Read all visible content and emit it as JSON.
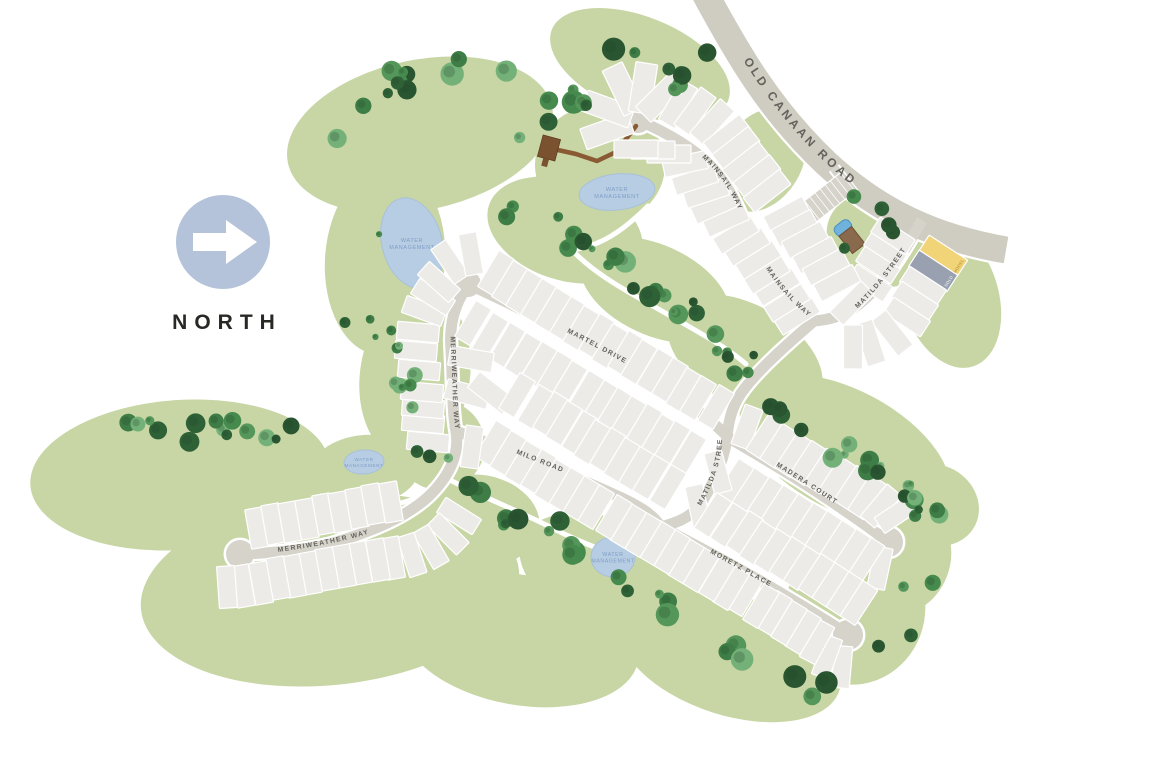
{
  "north_label": "NORTH",
  "water_label": [
    "WATER",
    "MANAGEMENT"
  ],
  "colors": {
    "green": "#c7d6a4",
    "road": "#d6d3cb",
    "highway": "#cfccc1",
    "lot": "#ecebe7",
    "lot_line": "#ffffff",
    "water": "#b7cde3",
    "water_text": "#7f9dc6",
    "number": "#4e4c46",
    "street_text": "#63625c",
    "north_circle": "#b4c3d9",
    "model": "#f2d478",
    "sold": "#99a1b0",
    "boardwalk": "#8a5a35",
    "trail": "#ffffff"
  },
  "special_lots": {
    "1": {
      "fill": "#f2d478",
      "edge_label": "MODEL",
      "edge_color": "#a98b2f"
    },
    "2": {
      "fill": "#99a1b0",
      "edge_label": "SOLD",
      "edge_color": "#ffffff"
    }
  },
  "streets": [
    {
      "name": "OLD CANAAN ROAD",
      "kind": "highway",
      "width": 27,
      "path": "M702,-12 C738,55 770,110 826,163 C880,213 936,238 1006,250",
      "labels": [
        {
          "offset": "20%",
          "size": 12,
          "spacing": 3.2
        }
      ]
    },
    {
      "name": "MAINSAIL WAY",
      "width": 11,
      "path": "M638,120 C672,135 700,152 716,172 C736,196 744,224 757,252 C770,280 793,305 814,321",
      "labels": [
        {
          "offset": "27%",
          "size": 6.8,
          "spacing": 1.3
        },
        {
          "offset": "74%",
          "size": 6.8,
          "spacing": 1.3
        }
      ]
    },
    {
      "name": "MATILDA STREET",
      "width": 11,
      "path": "M922,220 C904,252 884,286 854,308 C842,316 828,320 814,321",
      "labels": [
        {
          "size": 6.8,
          "spacing": 1.3,
          "offset": "2%",
          "path": "M856,310 C884,284 906,252 924,218"
        }
      ]
    },
    {
      "name": "MATILDA STREET",
      "width": 11,
      "path": "M814,321 C790,342 762,366 745,388 C733,403 729,418 727,436 C725,458 713,487 698,507 C688,519 675,523 661,527",
      "labels": [
        {
          "size": 6.8,
          "spacing": 1.3,
          "offset": "0%",
          "path": "M701,506 C713,484 721,464 722,440"
        }
      ]
    },
    {
      "name": "MARTEL DRIVE",
      "width": 11,
      "path": "M470,285 C520,308 580,338 630,366 C668,387 706,415 727,436",
      "labels": [
        {
          "offset": "36%",
          "size": 6.8,
          "spacing": 1.3
        }
      ]
    },
    {
      "name": "MERRIWEATHER WAY",
      "width": 11,
      "path": "M468,285 C454,305 449,325 451,350 C453,385 452,410 456,432 C460,455 448,478 428,497 C405,518 370,532 330,544 C300,551 270,553 240,554",
      "labels": [
        {
          "offset": "13%",
          "size": 6.8,
          "spacing": 1.3
        },
        {
          "size": 6.8,
          "spacing": 1.3,
          "offset": "0%",
          "path": "M278,552 C322,546 362,538 400,523"
        }
      ]
    },
    {
      "name": "MILO ROAD",
      "width": 11,
      "path": "M456,431 C515,453 565,472 613,494 C638,505 653,514 661,527",
      "labels": [
        {
          "offset": "28%",
          "size": 6.8,
          "spacing": 1.3
        }
      ]
    },
    {
      "name": "MADERA COURT",
      "width": 11,
      "path": "M727,437 C772,463 824,494 886,540",
      "labels": [
        {
          "offset": "30%",
          "size": 6.8,
          "spacing": 1.3
        }
      ]
    },
    {
      "name": "MORETZ PLACE",
      "width": 11,
      "path": "M661,527 C705,550 768,583 846,633",
      "labels": [
        {
          "offset": "26%",
          "size": 6.8,
          "spacing": 1.3
        }
      ]
    }
  ],
  "culdesacs": [
    [
      638,
      120,
      13
    ],
    [
      468,
      284,
      13
    ],
    [
      240,
      554,
      14
    ],
    [
      888,
      542,
      15
    ],
    [
      848,
      635,
      15
    ]
  ],
  "ponds": [
    {
      "cx": 412,
      "cy": 243,
      "rx": 30,
      "ry": 46,
      "rot": -15,
      "size": 5.5
    },
    {
      "cx": 617,
      "cy": 192,
      "rx": 38,
      "ry": 18,
      "rot": -6,
      "size": 5.5
    },
    {
      "cx": 364,
      "cy": 462,
      "rx": 20,
      "ry": 12,
      "rot": -4,
      "size": 4.6
    },
    {
      "cx": 613,
      "cy": 557,
      "rx": 22,
      "ry": 20,
      "rot": 0,
      "size": 5.2
    }
  ],
  "lot_rows": [
    {
      "pr": -57,
      "tr": -57,
      "w": 20,
      "h": 46,
      "lots": [
        [
          1,
          943,
          256
        ],
        [
          2,
          933,
          271
        ]
      ]
    },
    {
      "pr": -57,
      "tr": -40,
      "w": 19,
      "h": 44,
      "lots": [
        [
          3,
          923,
          286
        ],
        [
          4,
          915,
          301
        ],
        [
          5,
          907,
          317
        ],
        [
          6,
          892,
          333,
          -38
        ],
        [
          7,
          870,
          343,
          -18,
          -28
        ],
        [
          8,
          853,
          347,
          0,
          -12
        ]
      ]
    },
    {
      "pr": -57,
      "tr": -30,
      "w": 18,
      "h": 42,
      "lots": [
        [
          186,
          870,
          283
        ],
        [
          187,
          878,
          265
        ],
        [
          188,
          886,
          249
        ],
        [
          189,
          893,
          236
        ]
      ]
    },
    {
      "pr": 62,
      "tr": -28,
      "w": 19,
      "h": 44,
      "lots": [
        [
          179,
          787,
          215
        ],
        [
          180,
          795,
          228
        ],
        [
          181,
          805,
          240
        ],
        [
          182,
          816,
          255
        ],
        [
          183,
          826,
          267
        ],
        [
          184,
          837,
          283
        ],
        [
          185,
          852,
          303,
          45
        ]
      ]
    },
    {
      "pr": 58,
      "tr": -40,
      "w": 18,
      "h": 44,
      "lots": [
        [
          151,
          797,
          316
        ],
        [
          152,
          787,
          303
        ],
        [
          153,
          777,
          287
        ],
        [
          154,
          767,
          275
        ],
        [
          155,
          758,
          260
        ],
        [
          156,
          747,
          247
        ],
        [
          157,
          736,
          235
        ],
        [
          158,
          726,
          220,
          66,
          -15
        ],
        [
          159,
          714,
          207,
          66,
          -15
        ],
        [
          160,
          706,
          193,
          72,
          -12
        ],
        [
          161,
          695,
          180,
          72,
          -12
        ],
        [
          162,
          685,
          164,
          78,
          -15
        ],
        [
          163,
          669,
          154,
          90,
          0
        ],
        [
          164,
          653,
          150,
          90,
          0
        ],
        [
          165,
          636,
          149,
          90,
          0
        ]
      ]
    },
    {
      "fan": [
        638,
        120
      ],
      "tr": -8,
      "w": 22,
      "h": 50,
      "lots": [
        [
          166,
          607,
          131,
          null,
          -12
        ],
        [
          167,
          608,
          109,
          null,
          -12
        ],
        [
          168,
          623,
          89
        ],
        [
          169,
          643,
          88,
          null,
          -4
        ],
        [
          170,
          661,
          97,
          null,
          12
        ]
      ]
    },
    {
      "pr": 52,
      "tr": 42,
      "w": 19,
      "h": 46,
      "lots": [
        [
          171,
          678,
          104,
          30,
          18
        ],
        [
          172,
          695,
          111,
          36,
          26
        ],
        [
          173,
          712,
          122,
          42,
          34
        ],
        [
          174,
          727,
          136
        ],
        [
          175,
          736,
          148
        ],
        [
          176,
          746,
          163
        ],
        [
          177,
          757,
          176
        ],
        [
          178,
          767,
          191
        ]
      ]
    },
    {
      "pr": 31,
      "tr": 28,
      "w": 18,
      "h": 42,
      "lots": [
        [
          106,
          496,
          273
        ],
        [
          107,
          510,
          283
        ],
        [
          108,
          524,
          292
        ],
        [
          109,
          539,
          301
        ],
        [
          110,
          553,
          310
        ],
        [
          111,
          568,
          319
        ],
        [
          112,
          581,
          328
        ],
        [
          113,
          597,
          336
        ],
        [
          114,
          610,
          346
        ],
        [
          115,
          626,
          353
        ],
        [
          116,
          639,
          362
        ],
        [
          117,
          655,
          371
        ],
        [
          118,
          670,
          380
        ],
        [
          119,
          684,
          390
        ],
        [
          120,
          698,
          398
        ],
        [
          121,
          716,
          407
        ]
      ]
    },
    {
      "pr": 31,
      "tr": 28,
      "w": 18,
      "h": 42,
      "lots": [
        [
          122,
          688,
          453
        ],
        [
          123,
          672,
          443
        ],
        [
          124,
          656,
          435
        ],
        [
          125,
          644,
          426
        ],
        [
          126,
          628,
          418
        ],
        [
          127,
          613,
          409
        ],
        [
          128,
          599,
          401
        ],
        [
          129,
          586,
          393
        ],
        [
          130,
          569,
          383
        ],
        [
          131,
          554,
          373
        ],
        [
          132,
          539,
          364
        ],
        [
          133,
          523,
          355
        ],
        [
          134,
          507,
          345
        ],
        [
          135,
          490,
          335
        ],
        [
          136,
          473,
          323
        ]
      ]
    },
    {
      "pr": -80,
      "tr": 0,
      "w": 20,
      "h": 44,
      "lots": [
        [
          137,
          471,
          359
        ],
        [
          138,
          467,
          394,
          -75
        ],
        [
          139,
          491,
          393,
          -52
        ]
      ]
    },
    {
      "pr": 31,
      "tr": 28,
      "w": 18,
      "h": 42,
      "lots": [
        [
          140,
          517,
          395
        ],
        [
          141,
          536,
          407
        ],
        [
          142,
          551,
          414
        ],
        [
          143,
          564,
          423
        ],
        [
          144,
          580,
          433
        ],
        [
          145,
          592,
          442
        ],
        [
          146,
          608,
          450
        ],
        [
          147,
          622,
          460
        ],
        [
          148,
          637,
          469
        ],
        [
          149,
          651,
          477
        ],
        [
          150,
          668,
          487
        ]
      ]
    },
    {
      "pr": -85,
      "tr": 0,
      "w": 18,
      "h": 42,
      "lots": [
        [
          94,
          428,
          442
        ],
        [
          95,
          423,
          423
        ],
        [
          96,
          423,
          408
        ],
        [
          97,
          422,
          392
        ],
        [
          98,
          419,
          370
        ],
        [
          99,
          416,
          351
        ],
        [
          100,
          418,
          332
        ],
        [
          101,
          424,
          311,
          -70
        ],
        [
          102,
          433,
          297,
          -58
        ],
        [
          103,
          439,
          282,
          -48
        ],
        [
          104,
          450,
          262,
          -34
        ],
        [
          105,
          471,
          254,
          -10
        ]
      ]
    },
    {
      "pr": 31,
      "tr": 28,
      "w": 18,
      "h": 42,
      "lots": [
        [
          61,
          596,
          507
        ],
        [
          62,
          581,
          498
        ],
        [
          63,
          566,
          489
        ],
        [
          64,
          552,
          481
        ],
        [
          65,
          538,
          471
        ],
        [
          66,
          523,
          463
        ],
        [
          67,
          508,
          453
        ],
        [
          68,
          493,
          443
        ],
        [
          69,
          472,
          447,
          8,
          0
        ]
      ]
    },
    {
      "pr": 31,
      "tr": 28,
      "w": 18,
      "h": 42,
      "lots": [
        [
          44,
          842,
          667,
          5,
          20
        ],
        [
          45,
          827,
          657,
          20,
          24
        ],
        [
          46,
          817,
          642,
          28
        ],
        [
          47,
          803,
          632
        ],
        [
          48,
          789,
          623
        ],
        [
          49,
          774,
          613
        ],
        [
          50,
          761,
          606
        ],
        [
          51,
          745,
          594
        ],
        [
          52,
          731,
          588
        ],
        [
          53,
          717,
          579
        ],
        [
          54,
          701,
          570
        ],
        [
          55,
          686,
          561
        ],
        [
          56,
          672,
          552
        ],
        [
          57,
          657,
          543
        ],
        [
          58,
          643,
          535
        ],
        [
          59,
          628,
          526
        ],
        [
          60,
          614,
          517
        ]
      ]
    },
    {
      "pr": 33,
      "tr": 30,
      "w": 18,
      "h": 42,
      "lots": [
        [
          20,
          880,
          568,
          12,
          12
        ],
        [
          21,
          866,
          559
        ],
        [
          22,
          852,
          551
        ],
        [
          23,
          837,
          542
        ],
        [
          24,
          823,
          533
        ],
        [
          25,
          808,
          524
        ],
        [
          26,
          794,
          516
        ],
        [
          27,
          779,
          507
        ],
        [
          28,
          764,
          498
        ],
        [
          29,
          750,
          490
        ],
        [
          30,
          735,
          481
        ],
        [
          31,
          718,
          472,
          -15,
          -18
        ]
      ]
    },
    {
      "pr": 33,
      "tr": 30,
      "w": 18,
      "h": 42,
      "lots": [
        [
          32,
          698,
          506,
          -12,
          -12
        ],
        [
          33,
          713,
          515
        ],
        [
          34,
          729,
          525
        ],
        [
          35,
          745,
          533
        ],
        [
          36,
          758,
          543
        ],
        [
          37,
          773,
          551
        ],
        [
          38,
          788,
          559
        ],
        [
          39,
          802,
          568
        ],
        [
          40,
          817,
          576
        ],
        [
          41,
          831,
          585
        ],
        [
          42,
          845,
          594
        ],
        [
          43,
          859,
          603
        ]
      ]
    },
    {
      "pr": 33,
      "tr": 30,
      "w": 19,
      "h": 42,
      "lots": [
        [
          9,
          747,
          427,
          20,
          12
        ],
        [
          10,
          765,
          437
        ],
        [
          11,
          779,
          446
        ],
        [
          12,
          794,
          455
        ],
        [
          13,
          808,
          463
        ],
        [
          14,
          823,
          471
        ],
        [
          15,
          837,
          479
        ],
        [
          16,
          853,
          488
        ],
        [
          17,
          867,
          497
        ],
        [
          18,
          881,
          506,
          40,
          34
        ],
        [
          19,
          897,
          514,
          56,
          40
        ]
      ]
    },
    {
      "pr": -10,
      "tr": -8,
      "w": 18,
      "h": 42,
      "lots": [
        [
          70,
          459,
          516,
          -58,
          -45
        ],
        [
          71,
          448,
          534,
          -45,
          -34
        ],
        [
          72,
          431,
          547,
          -30,
          -22
        ],
        [
          73,
          412,
          555,
          -18,
          -14
        ],
        [
          74,
          393,
          558
        ],
        [
          75,
          378,
          560
        ],
        [
          76,
          360,
          563
        ],
        [
          77,
          344,
          566
        ],
        [
          78,
          327,
          569
        ],
        [
          79,
          310,
          573
        ],
        [
          80,
          294,
          576
        ],
        [
          81,
          278,
          578
        ],
        [
          82,
          261,
          583
        ],
        [
          83,
          243,
          586
        ],
        [
          84,
          227,
          587,
          -4,
          -4
        ]
      ]
    },
    {
      "pr": -10,
      "tr": -8,
      "w": 18,
      "h": 40,
      "lots": [
        [
          85,
          257,
          528
        ],
        [
          86,
          273,
          524
        ],
        [
          87,
          290,
          522
        ],
        [
          88,
          307,
          519
        ],
        [
          89,
          324,
          514
        ],
        [
          90,
          340,
          512
        ],
        [
          91,
          357,
          508
        ],
        [
          92,
          373,
          504
        ],
        [
          93,
          391,
          502
        ]
      ]
    }
  ]
}
